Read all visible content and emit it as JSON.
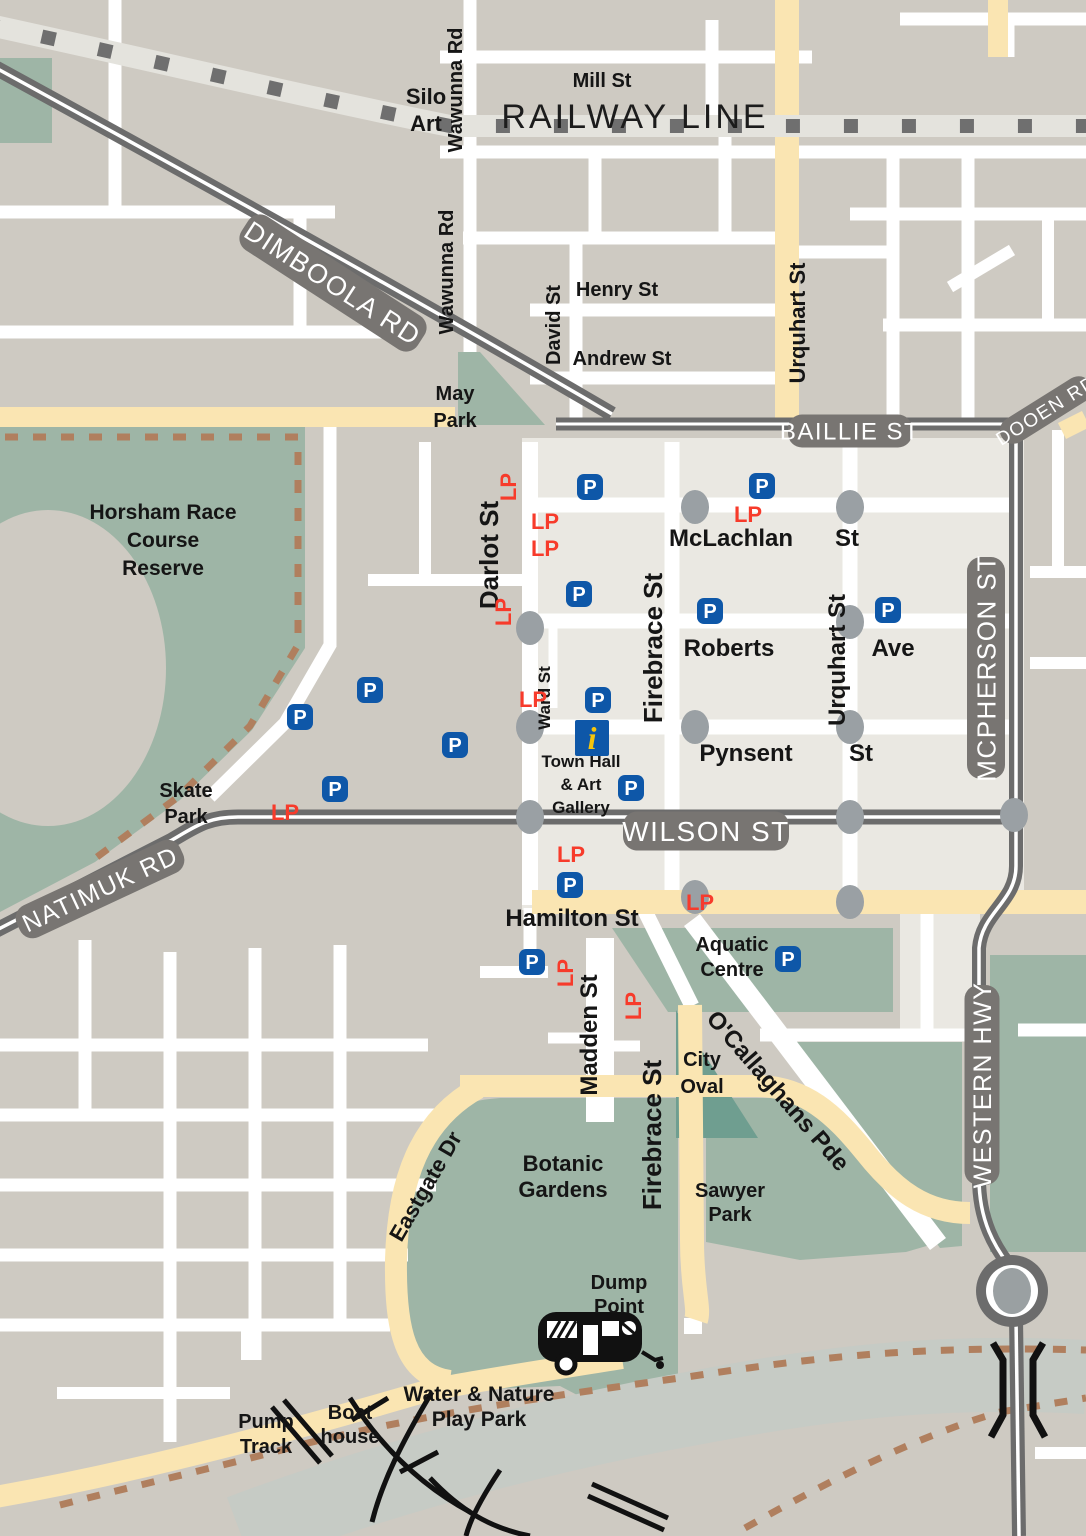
{
  "map": {
    "colors": {
      "block_grey": "#cecac2",
      "cbd_light": "#eae8e2",
      "park_green": "#9eb5a6",
      "oval_green": "#6f9e90",
      "road_cream": "#fae5b2",
      "major_road_grey": "#6c6c6c",
      "pill_grey": "#787572",
      "railway_band": "#e4e3dd",
      "trail_brown": "#b07f5e",
      "river_grey": "#c6cbc5",
      "intersection_grey": "#9aa0a4",
      "parking_blue": "#0e57a8",
      "lp_red": "#f73b2b",
      "info_blue": "#0e57a8",
      "info_yellow": "#f6c50b"
    },
    "road_pills": [
      {
        "name": "pill-dimboola-rd",
        "text": "DIMBOOLA RD",
        "x": 333,
        "y": 283,
        "rot": 33,
        "w": 210,
        "h": 40,
        "size": 27
      },
      {
        "name": "pill-baillie-st",
        "text": "BAILLIE ST",
        "x": 850,
        "y": 431,
        "rot": 0,
        "w": 124,
        "h": 33,
        "size": 24
      },
      {
        "name": "pill-dooen-rd",
        "text": "DOOEN RD",
        "x": 1046,
        "y": 410,
        "rot": -32,
        "w": 104,
        "h": 27,
        "size": 19
      },
      {
        "name": "pill-wilson-st",
        "text": "WILSON ST",
        "x": 706,
        "y": 831,
        "rot": 0,
        "w": 166,
        "h": 39,
        "size": 28
      },
      {
        "name": "pill-natimuk-rd",
        "text": "NATIMUK RD",
        "x": 100,
        "y": 889,
        "rot": -25,
        "w": 180,
        "h": 35,
        "size": 25
      },
      {
        "name": "pill-mcpherson-st",
        "text": "MCPHERSON ST",
        "x": 986,
        "y": 668,
        "rot": -90,
        "w": 222,
        "h": 38,
        "size": 26
      },
      {
        "name": "pill-western-hwy",
        "text": "WESTERN HWY",
        "x": 982,
        "y": 1085,
        "rot": -90,
        "w": 200,
        "h": 35,
        "size": 25
      }
    ],
    "region_labels": [
      {
        "name": "label-silo-art",
        "lines": [
          "Silo",
          "Art"
        ],
        "x": 426,
        "y": 104,
        "lh": 27,
        "size": 22
      },
      {
        "name": "label-mill-st",
        "lines": [
          "Mill St"
        ],
        "x": 602,
        "y": 87,
        "size": 20
      },
      {
        "name": "label-railway-line",
        "lines": [
          "RAILWAY LINE"
        ],
        "x": 635,
        "y": 128,
        "size": 34,
        "weight": 400,
        "spacing": 3
      },
      {
        "name": "label-wawunna-rd-top",
        "lines": [
          "Wawunna Rd"
        ],
        "x": 462,
        "y": 90,
        "rot": -90,
        "size": 20
      },
      {
        "name": "label-wawunna-rd-mid",
        "lines": [
          "Wawunna Rd"
        ],
        "x": 453,
        "y": 272,
        "rot": -90,
        "size": 20
      },
      {
        "name": "label-henry-st",
        "lines": [
          "Henry St"
        ],
        "x": 617,
        "y": 296,
        "size": 20
      },
      {
        "name": "label-andrew-st",
        "lines": [
          "Andrew St"
        ],
        "x": 622,
        "y": 365,
        "size": 20
      },
      {
        "name": "label-david-st",
        "lines": [
          "David St"
        ],
        "x": 560,
        "y": 325,
        "rot": -90,
        "size": 20
      },
      {
        "name": "label-urquhart-st-top",
        "lines": [
          "Urquhart St"
        ],
        "x": 805,
        "y": 323,
        "rot": -90,
        "size": 22
      },
      {
        "name": "label-may-park",
        "lines": [
          "May",
          "Park"
        ],
        "x": 455,
        "y": 400,
        "lh": 27,
        "size": 20
      },
      {
        "name": "label-horsham-race-course",
        "lines": [
          "Horsham Race",
          "Course",
          "Reserve"
        ],
        "x": 163,
        "y": 519,
        "lh": 28,
        "size": 21
      },
      {
        "name": "label-darlot-st",
        "lines": [
          "Darlot St"
        ],
        "x": 498,
        "y": 555,
        "rot": -90,
        "size": 26
      },
      {
        "name": "label-mclachlan",
        "lines": [
          "McLachlan"
        ],
        "x": 731,
        "y": 546,
        "size": 24
      },
      {
        "name": "label-mclachlan-st-suffix",
        "lines": [
          "St"
        ],
        "x": 847,
        "y": 546,
        "size": 24
      },
      {
        "name": "label-firebrace-st-cbd",
        "lines": [
          "Firebrace St"
        ],
        "x": 662,
        "y": 648,
        "rot": -90,
        "size": 26
      },
      {
        "name": "label-roberts",
        "lines": [
          "Roberts"
        ],
        "x": 729,
        "y": 656,
        "size": 24
      },
      {
        "name": "label-roberts-ave-suffix",
        "lines": [
          "Ave"
        ],
        "x": 893,
        "y": 656,
        "size": 24
      },
      {
        "name": "label-urquhart-st-cbd",
        "lines": [
          "Urquhart St"
        ],
        "x": 845,
        "y": 660,
        "rot": -90,
        "size": 24
      },
      {
        "name": "label-pynsent",
        "lines": [
          "Pynsent"
        ],
        "x": 746,
        "y": 761,
        "size": 24
      },
      {
        "name": "label-pynsent-st-suffix",
        "lines": [
          "St"
        ],
        "x": 861,
        "y": 761,
        "size": 24
      },
      {
        "name": "label-ward-st",
        "lines": [
          "Ward St"
        ],
        "x": 550,
        "y": 698,
        "rot": -90,
        "size": 17
      },
      {
        "name": "label-town-hall",
        "lines": [
          "Town Hall",
          "& Art",
          "Gallery"
        ],
        "x": 581,
        "y": 767,
        "lh": 23,
        "size": 17
      },
      {
        "name": "label-skate-park",
        "lines": [
          "Skate",
          "Park"
        ],
        "x": 186,
        "y": 797,
        "lh": 26,
        "size": 20
      },
      {
        "name": "label-hamilton-st",
        "lines": [
          "Hamilton St"
        ],
        "x": 572,
        "y": 926,
        "size": 24
      },
      {
        "name": "label-aquatic-centre",
        "lines": [
          "Aquatic",
          "Centre"
        ],
        "x": 732,
        "y": 951,
        "lh": 25,
        "size": 20
      },
      {
        "name": "label-madden-st",
        "lines": [
          "Madden St"
        ],
        "x": 597,
        "y": 1035,
        "rot": -90,
        "size": 24
      },
      {
        "name": "label-city-oval",
        "lines": [
          "City",
          "Oval"
        ],
        "x": 702,
        "y": 1066,
        "lh": 27,
        "size": 20
      },
      {
        "name": "label-ocallaghans-pde",
        "lines": [
          "O'Callaghans Pde"
        ],
        "x": 772,
        "y": 1096,
        "rot": 49,
        "size": 24
      },
      {
        "name": "label-firebrace-st-south",
        "lines": [
          "Firebrace St"
        ],
        "x": 661,
        "y": 1135,
        "rot": -90,
        "size": 26
      },
      {
        "name": "label-botanic-gardens",
        "lines": [
          "Botanic",
          "Gardens"
        ],
        "x": 563,
        "y": 1171,
        "lh": 26,
        "size": 22
      },
      {
        "name": "label-sawyer-park",
        "lines": [
          "Sawyer",
          "Park"
        ],
        "x": 730,
        "y": 1197,
        "lh": 24,
        "size": 20
      },
      {
        "name": "label-eastgate-dr",
        "lines": [
          "Eastgate Dr"
        ],
        "x": 432,
        "y": 1190,
        "rot": -60,
        "size": 22
      },
      {
        "name": "label-dump-point",
        "lines": [
          "Dump",
          "Point"
        ],
        "x": 619,
        "y": 1289,
        "lh": 24,
        "size": 20
      },
      {
        "name": "label-water-nature-play-park",
        "lines": [
          "Water & Nature",
          "Play Park"
        ],
        "x": 479,
        "y": 1401,
        "lh": 25,
        "size": 21
      },
      {
        "name": "label-pump-track",
        "lines": [
          "Pump",
          "Track"
        ],
        "x": 266,
        "y": 1428,
        "lh": 25,
        "size": 20
      },
      {
        "name": "label-boat-house",
        "lines": [
          "Boat",
          "house"
        ],
        "x": 350,
        "y": 1419,
        "lh": 24,
        "size": 20
      }
    ],
    "parking_markers": {
      "glyph": "P",
      "positions": [
        [
          590,
          487
        ],
        [
          762,
          486
        ],
        [
          579,
          594
        ],
        [
          710,
          611
        ],
        [
          888,
          610
        ],
        [
          598,
          700
        ],
        [
          631,
          788
        ],
        [
          370,
          690
        ],
        [
          300,
          717
        ],
        [
          455,
          745
        ],
        [
          335,
          789
        ],
        [
          570,
          885
        ],
        [
          532,
          962
        ],
        [
          788,
          959
        ]
      ]
    },
    "loading_markers": {
      "glyph": "LP",
      "positions": [
        {
          "x": 516,
          "y": 487,
          "rot": -90
        },
        {
          "x": 545,
          "y": 529,
          "rot": 0
        },
        {
          "x": 545,
          "y": 556,
          "rot": 0
        },
        {
          "x": 511,
          "y": 612,
          "rot": -90
        },
        {
          "x": 748,
          "y": 522,
          "rot": 0
        },
        {
          "x": 533,
          "y": 707,
          "rot": 0
        },
        {
          "x": 285,
          "y": 820,
          "rot": 0
        },
        {
          "x": 571,
          "y": 862,
          "rot": 0
        },
        {
          "x": 700,
          "y": 910,
          "rot": 0
        },
        {
          "x": 573,
          "y": 973,
          "rot": -90
        },
        {
          "x": 641,
          "y": 1006,
          "rot": -90
        }
      ]
    },
    "info_marker": {
      "glyph": "i",
      "x": 592,
      "y": 738
    },
    "intersections": [
      [
        695,
        507
      ],
      [
        850,
        507
      ],
      [
        530,
        628
      ],
      [
        850,
        622
      ],
      [
        530,
        727
      ],
      [
        695,
        727
      ],
      [
        850,
        727
      ],
      [
        530,
        817
      ],
      [
        850,
        817
      ],
      [
        1014,
        815
      ],
      [
        695,
        897
      ],
      [
        850,
        902
      ]
    ]
  }
}
